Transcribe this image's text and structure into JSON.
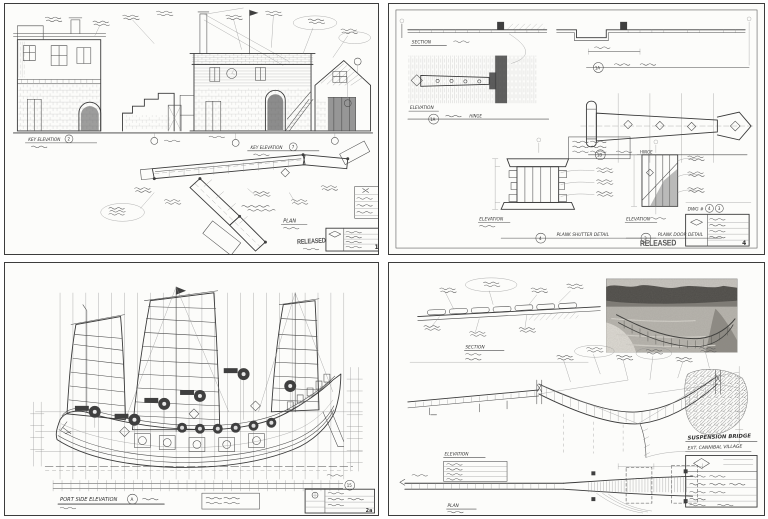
{
  "colors": {
    "paper": "#fcfcfa",
    "ink": "#3a3a3a",
    "border": "#3c3c3c",
    "stamp_gray": "#565656"
  },
  "sheets": {
    "village": {
      "key_elevation": "KEY ELEVATION",
      "callout_left": "2",
      "callout_right": "7",
      "plan_label": "PLAN",
      "released": "RELEASED",
      "sheet_no": "1"
    },
    "hinges": {
      "section_label": "SECTION",
      "elevation_label": "ELEVATION",
      "hinge_small_callout": "1A",
      "hinge_small_label": "HINGE",
      "hinge_large_callout": "1B",
      "hinge_large_label": "HINGE",
      "reverse_callout": "1A",
      "shutter_callout": "4",
      "shutter_title": "PLANK SHUTTER DETAIL",
      "door_callout": "3",
      "door_title": "PLANK DOOR DETAIL",
      "dwg_label": "DWG #",
      "dwg_no_1": "4",
      "dwg_no_2": "3",
      "released": "RELEASED",
      "sheet_no": "4"
    },
    "junk": {
      "title": "PORT SIDE ELEVATION",
      "title_callout": "A",
      "dim_callout": "15",
      "sheet_no": "2a"
    },
    "bridge": {
      "section_label": "SECTION",
      "elevation_label": "ELEVATION",
      "plan_label": "PLAN",
      "title_line1": "SUSPENSION BRIDGE",
      "title_line2": "EXT. CANNIBAL VILLAGE"
    }
  }
}
